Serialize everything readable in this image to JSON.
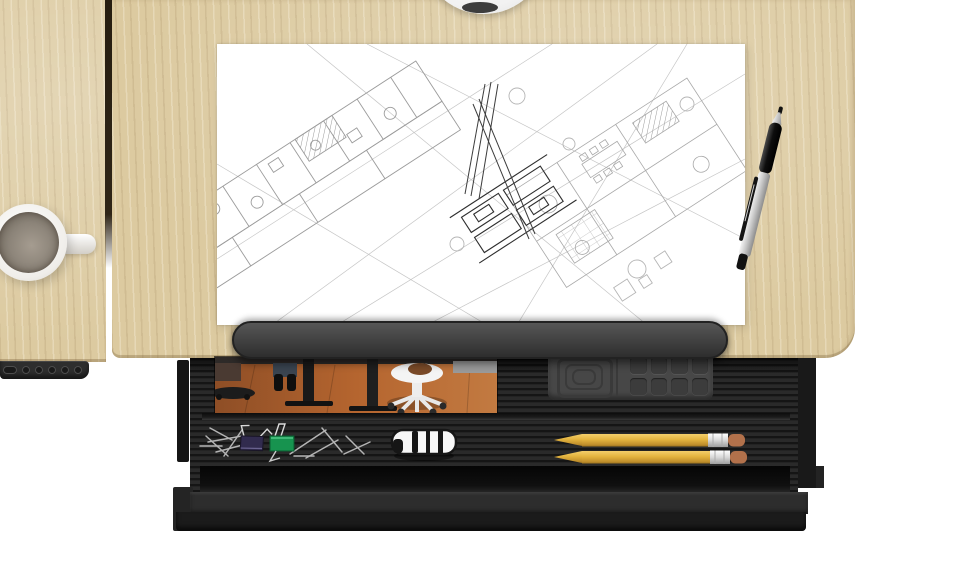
{
  "scene": {
    "kind": "3d-product-render",
    "description": "Top-down view of a light-wood sit-stand desk with an architectural blueprint, ballpoint pen and coffee mug on top, a height-adjustment keypad on the left edge, and an open black organizer drawer below containing a photo print, a molded compartment tray, paper clips, two binder clips, a white toy car and two yellow pencils."
  },
  "objects": {
    "desk_return": "left desk return surface",
    "desk_main": "main desk top surface",
    "height_controller": "desk height keypad with six buttons",
    "round_object_top": "white round object cut off at top edge",
    "blueprint": "architectural wireframe floor-plan drawing on white paper",
    "pen": "silver ballpoint pen with black grip and clip",
    "coffee_mug": "white mug with coffee, handle pointing right",
    "pen_tray_lid": "rounded dark pen-tray lid bar",
    "drawer": "open drawer with ribbed black interior",
    "drawer_photo": "photo print of an office scene with chairs",
    "organizer_tray": "dark molded tray with square recess and 2x4 compartments",
    "paperclips": "scattered silver paper clips",
    "binder_clip_green": "green binder clip",
    "binder_clip_dark": "dark navy binder clip",
    "toy_car": "white toy car, top view",
    "pencils": "two sharpened yellow pencils with erasers"
  },
  "keypad": {
    "button_count": 6
  },
  "organizer": {
    "compartment_count": 8,
    "rows": 2,
    "columns": 4
  },
  "pencils": {
    "count": 2
  },
  "colors": {
    "background": "#ffffff",
    "wood": "#dccaa0",
    "seam": "#261d10",
    "keypad": "#2e2e2e",
    "paper": "#ffffff",
    "blueprint_line": "#9b9b9b",
    "blueprint_dark": "#2e2e2e",
    "tray_bar": "#3f3f3f",
    "drawer_body": "#2a2a2a",
    "drawer_front": "#2d2d2d",
    "drawer_floor": "#0d0d0d",
    "organizer": "#474747",
    "photo_floor": "#a75a2e",
    "pencil_yellow": "#e3b33e",
    "pencil_eraser": "#b2714b",
    "pencil_ferrule": "#e8e8e8",
    "binder_green": "#17934f",
    "binder_dark": "#312b4e",
    "paperclip_silver": "#b4b4b4",
    "car_body": "#f7f7f7",
    "car_trim": "#161616",
    "coffee": "#8d857a",
    "mug": "#ffffff",
    "pen_grip": "#1a1a1a",
    "pen_barrel": "#c9c9c9"
  }
}
